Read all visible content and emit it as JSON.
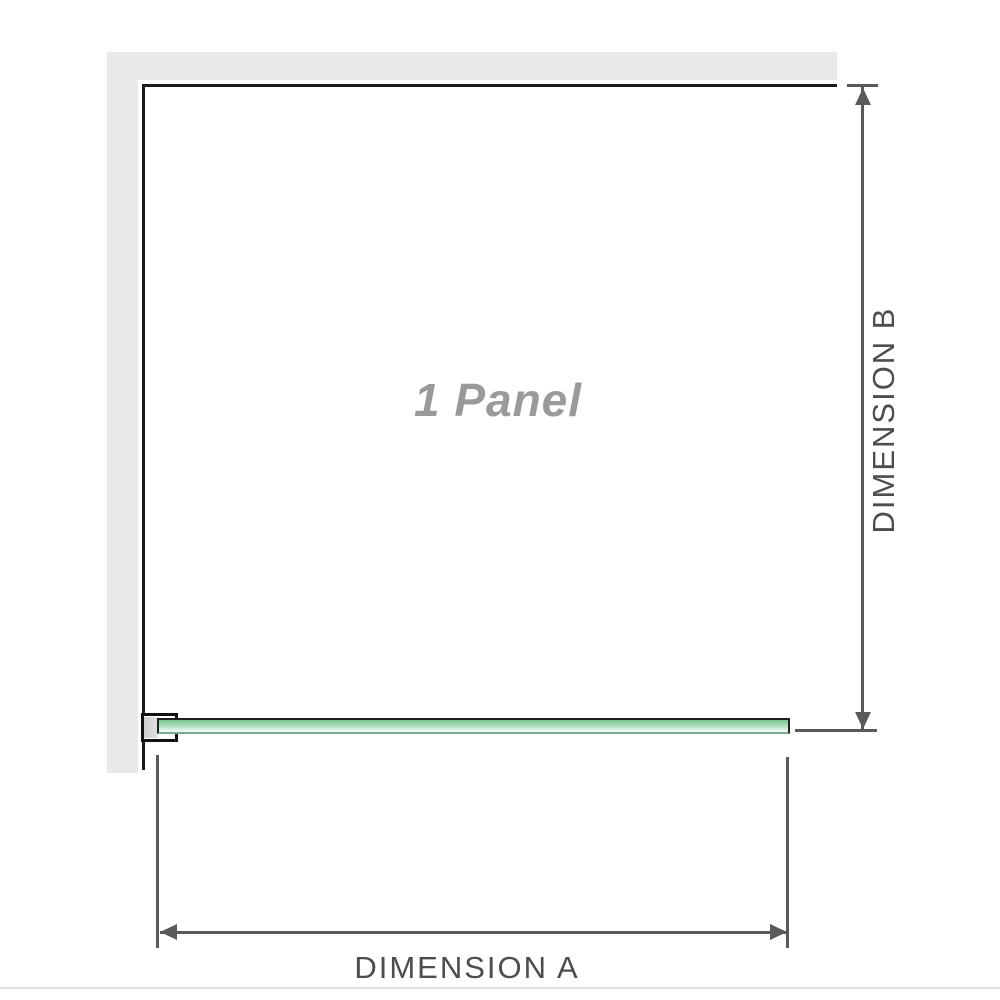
{
  "diagram": {
    "title": "shower-screen-panel-dimension-diagram",
    "panel_label": "1 Panel",
    "dimension_a": {
      "label": "DIMENSION A",
      "orientation": "horizontal"
    },
    "dimension_b": {
      "label": "DIMENSION B",
      "orientation": "vertical"
    },
    "colors": {
      "wall_gray": "#e9e9e9",
      "panel_border_black": "#1a1a1a",
      "dimension_gray": "#5a5a5a",
      "label_gray": "#4d4d4d",
      "panel_text_gray": "#9a9a9a",
      "glass_green": "#a9d9b6",
      "glass_green_dark": "#7cc492",
      "glass_green_light": "#f4fbf6"
    }
  }
}
